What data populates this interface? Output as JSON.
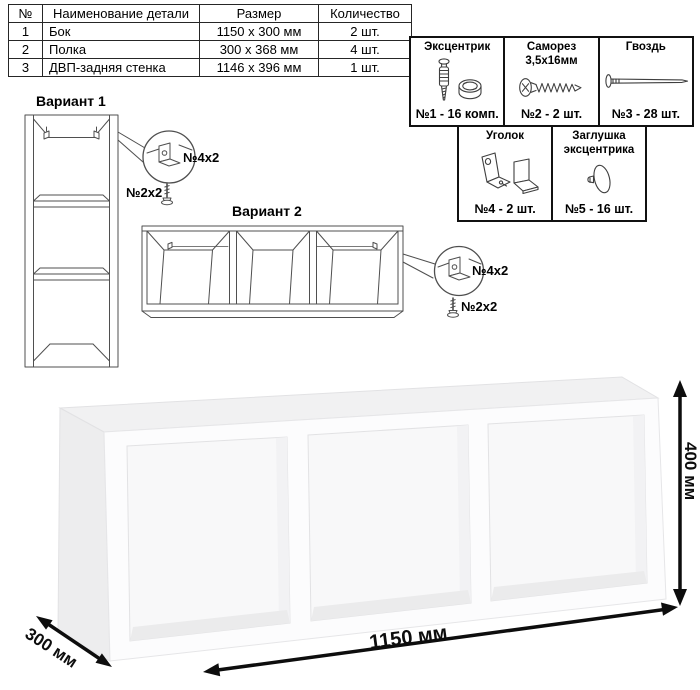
{
  "parts_table": {
    "headers": {
      "num": "№",
      "name": "Наименование детали",
      "size": "Размер",
      "qty": "Количество"
    },
    "rows": [
      {
        "num": "1",
        "name": "Бок",
        "size": "1150 х 300 мм",
        "qty": "2 шт."
      },
      {
        "num": "2",
        "name": "Полка",
        "size": "300 х 368 мм",
        "qty": "4 шт."
      },
      {
        "num": "3",
        "name": "ДВП-задняя стенка",
        "size": "1146 х 396 мм",
        "qty": "1 шт."
      }
    ]
  },
  "hardware": {
    "items": [
      {
        "title": "Эксцентрик",
        "label": "№1 - 16 комп.",
        "icon": "cam-bolt-icon"
      },
      {
        "title": "Саморез 3,5х16мм",
        "label": "№2 - 2 шт.",
        "icon": "screw-icon"
      },
      {
        "title": "Гвоздь",
        "label": "№3 - 28 шт.",
        "icon": "nail-icon"
      },
      {
        "title": "Уголок",
        "label": "№4 - 2 шт.",
        "icon": "corner-bracket-icon"
      },
      {
        "title": "Заглушка эксцентрика",
        "label": "№5 - 16 шт.",
        "icon": "cam-cap-icon"
      }
    ]
  },
  "variant1": {
    "title": "Вариант 1",
    "bracket_label": "№4х2",
    "screw_label": "№2х2"
  },
  "variant2": {
    "title": "Вариант 2",
    "bracket_label": "№4х2",
    "screw_label": "№2х2"
  },
  "dimensions": {
    "width": "1150 мм",
    "depth": "300 мм",
    "height": "400 мм"
  },
  "colors": {
    "line": "#4f4f4f",
    "border": "#111111",
    "arrow": "#0d0d0d",
    "render_top": "#f1f1f2",
    "render_front": "#fcfcfd",
    "render_inner": "#f8f8f9"
  }
}
